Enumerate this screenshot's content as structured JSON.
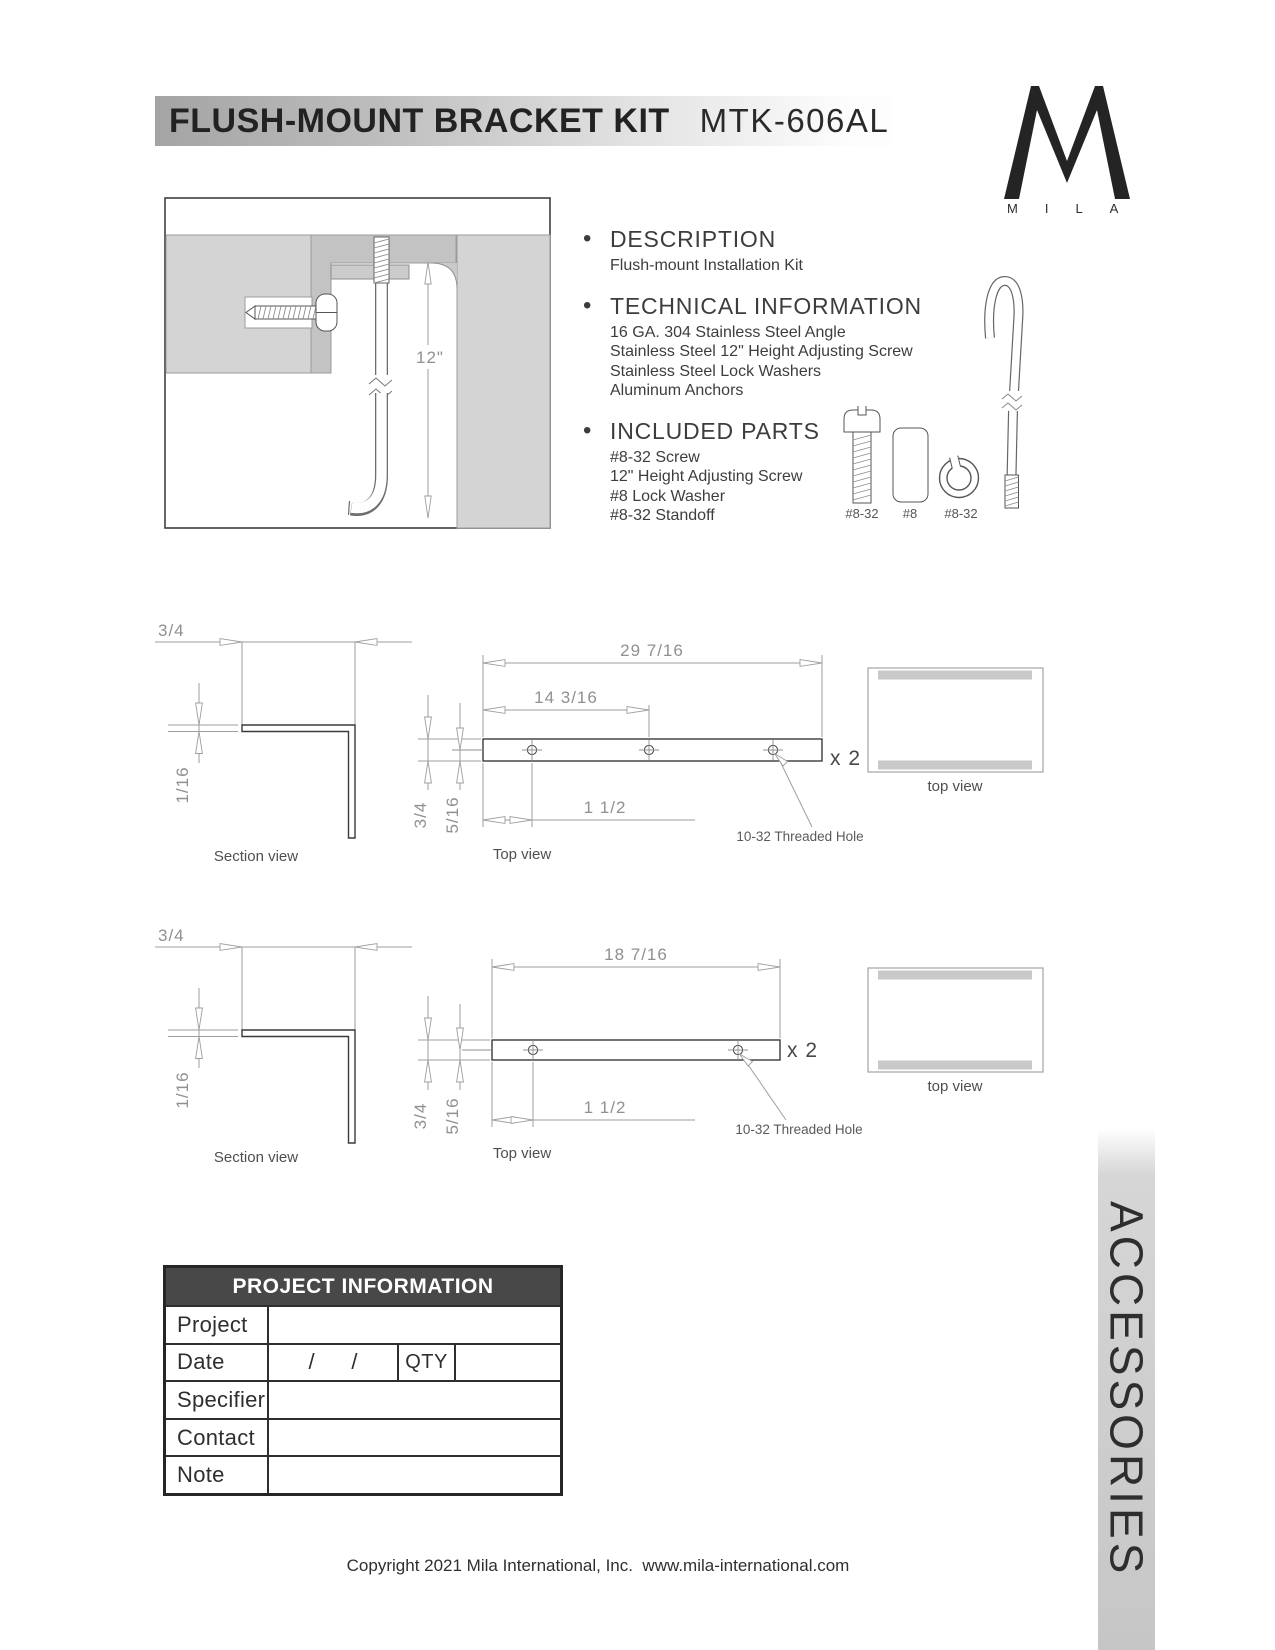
{
  "header": {
    "title": "FLUSH-MOUNT BRACKET KIT",
    "model": "MTK-606AL",
    "brand_wordmark": "MILA"
  },
  "install_diagram": {
    "height_dim": "12\""
  },
  "description": {
    "heading": "DESCRIPTION",
    "lines": [
      "Flush-mount Installation Kit"
    ]
  },
  "technical": {
    "heading": "TECHNICAL INFORMATION",
    "lines": [
      "16 GA. 304 Stainless Steel Angle",
      "Stainless Steel 12\" Height Adjusting Screw",
      "Stainless Steel Lock Washers",
      "Aluminum Anchors"
    ]
  },
  "included": {
    "heading": "INCLUDED PARTS",
    "lines": [
      "#8-32 Screw",
      "12\" Height Adjusting Screw",
      "#8 Lock Washer",
      "#8-32 Standoff"
    ]
  },
  "parts_row": {
    "labels": [
      "#8-32",
      "#8",
      "#8-32"
    ]
  },
  "drawing1": {
    "angle_width": "3/4",
    "thickness": "1/16",
    "overall_length": "29 7/16",
    "mid_hole_dim": "14 3/16",
    "end_hole_dim": "1 1/2",
    "depth": "3/4",
    "hole_offset": "5/16",
    "quantity": "x 2",
    "hole_note": "10-32 Threaded Hole",
    "section_label": "Section view",
    "top_label": "Top view",
    "end_view_label": "top view"
  },
  "drawing2": {
    "angle_width": "3/4",
    "thickness": "1/16",
    "overall_length": "18 7/16",
    "end_hole_dim": "1 1/2",
    "depth": "3/4",
    "hole_offset": "5/16",
    "quantity": "x 2",
    "hole_note": "10-32 Threaded Hole",
    "section_label": "Section view",
    "top_label": "Top view",
    "end_view_label": "top view"
  },
  "project_table": {
    "title": "PROJECT INFORMATION",
    "row_labels": [
      "Project",
      "Date",
      "Specifier",
      "Contact",
      "Note"
    ],
    "date_slashes": "/      /",
    "qty_label": "QTY"
  },
  "side_tab": "ACCESSORIES",
  "footer": "Copyright 2021 Mila International, Inc.  www.mila-international.com"
}
